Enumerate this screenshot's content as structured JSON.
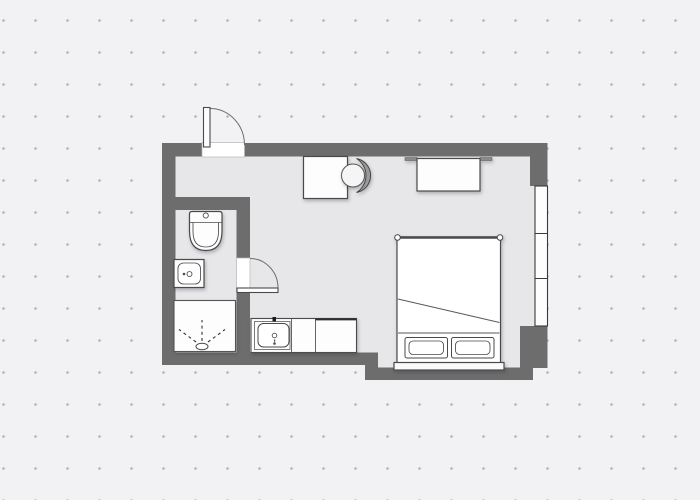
{
  "canvas": {
    "width": 700,
    "height": 500
  },
  "colors": {
    "bg": "#f2f2f5",
    "dot": "#b2b2ba",
    "wall": "#6d6d6d",
    "floor": "#e7e7ea",
    "fixture": "#fdfdfd",
    "line": "#4a4a4a",
    "swing": "#6f6f6f",
    "chair-back": "#9a9a9a"
  },
  "floorplan": {
    "type": "studio-apartment-floor-plan",
    "rooms": [
      {
        "name": "main-room",
        "fixtures": [
          "bed",
          "desk",
          "chair",
          "wardrobe",
          "kitchen-counter",
          "kitchen-sink",
          "window"
        ]
      },
      {
        "name": "bathroom",
        "fixtures": [
          "toilet",
          "washbasin",
          "shower"
        ]
      }
    ],
    "doors": [
      {
        "name": "entrance-door",
        "wall": "top",
        "swing": "outward"
      },
      {
        "name": "bathroom-door",
        "wall": "bathroom-right",
        "swing": "into-main-room"
      }
    ],
    "window_panes": 3,
    "bed_pillows": 2
  }
}
